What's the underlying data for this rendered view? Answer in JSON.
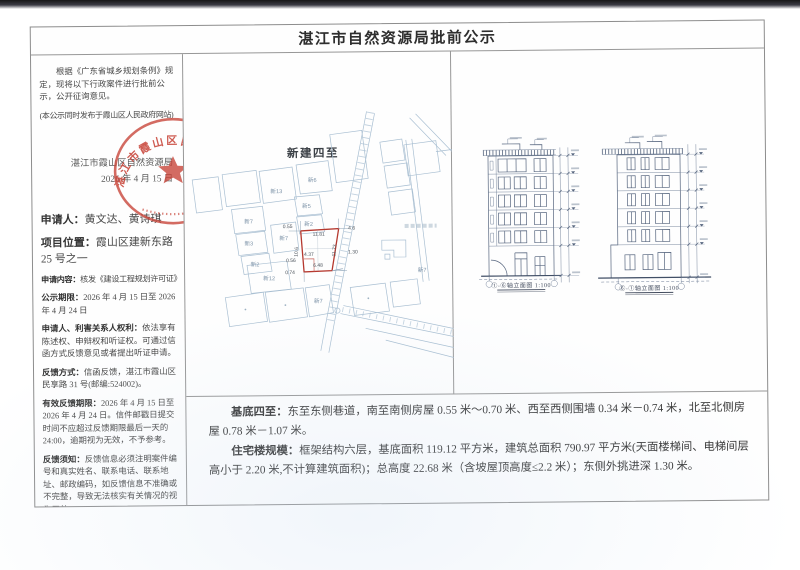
{
  "page": {
    "title": "湛江市自然资源局批前公示"
  },
  "left_column": {
    "intro": "根据《广东省城乡规划条例》规定，现将以下行政案件进行批前公示，公开征询意见。",
    "intro_note": "(本公示同时发布于霞山区人民政府网站)",
    "authority": "湛江市霞山区自然资源局",
    "date": "2026 年 4 月 15 日",
    "seal_text": "湛江市霞山区自然资源局",
    "fields": [
      {
        "label": "申请人：",
        "value": "黄文达、黄诗琪"
      },
      {
        "label": "项目位置：",
        "value": "霞山区建新东路 25 号之一"
      },
      {
        "label": "申请内容：",
        "value": "核发《建设工程规划许可证》"
      },
      {
        "label": "公示期限：",
        "value": "2026 年 4 月 15 日至 2026 年 4 月 24 日"
      },
      {
        "label": "申请人、利害关系人权利：",
        "value": "依法享有陈述权、申辩权和听证权。可通过信函方式反馈意见或者提出听证申请。"
      },
      {
        "label": "反馈方式：",
        "value": "信函反馈，湛江市霞山区民享路 31 号(邮编:524002)。"
      },
      {
        "label": "有效反馈期限：",
        "value": "2026 年 4 月 15 日至 2026 年 4 月 24 日。信件邮戳日提交时间不应超过反馈期限最后一天的 24:00，逾期视为无效，不予参考。"
      },
      {
        "label": "反馈须知：",
        "value": "反馈信息必须注明案件编号和真实姓名、联系电话、联系地址、邮政编码，如反馈信息不准确或不完整，导致无法核实有关情况的视为无效。"
      }
    ]
  },
  "site_plan": {
    "title": "新建四至",
    "parcel_labels": [
      "新6",
      "新13",
      "新5",
      "新2",
      "新7",
      "新3",
      "新2",
      "新7",
      "新12",
      "新7",
      "新7"
    ],
    "dimensions": [
      "0.55",
      "11.81",
      "10.6",
      "4.37",
      "0.56",
      "6.48",
      "0.74",
      "11.73",
      "1.30",
      "4.6"
    ]
  },
  "elevations": [
    {
      "caption": "①-⑥轴立面图 1:100"
    },
    {
      "caption": "⑥-①轴立面图 1:100"
    }
  ],
  "summary": {
    "p1_label": "基底四至：",
    "p1": "东至东侧巷道，南至南侧房屋 0.55 米～0.70 米、西至西侧围墙 0.34 米－0.74 米，北至北侧房屋 0.78 米－1.07 米。",
    "p2_label": "住宅楼规模：",
    "p2": "框架结构六层，基底面积 119.12 平方米，建筑总面积 790.97 平方米(天面楼梯间、电梯间层高小于 2.20 米,不计算建筑面积)；总高度 22.68 米（含坡屋顶高度≤2.2 米）；东侧外挑进深 1.30 米。"
  },
  "colors": {
    "seal_red": "#c8453a",
    "plan_red": "#b5382e",
    "map_line": "#a9bfd2",
    "drawing_line": "#56657e"
  }
}
